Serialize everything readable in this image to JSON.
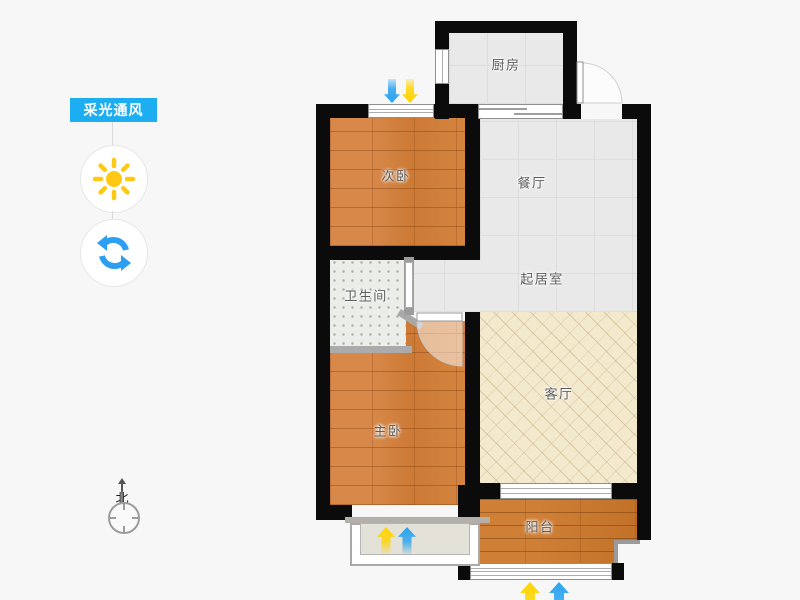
{
  "sidebar": {
    "tooltip": "采光通风",
    "compass": "北"
  },
  "rooms": {
    "kitchen": "厨房",
    "secondary_bedroom": "次卧",
    "dining": "餐厅",
    "bathroom": "卫生间",
    "sitting": "起居室",
    "master_bedroom": "主卧",
    "living": "客厅",
    "balcony": "阳台"
  },
  "icons": {
    "sun": "sun-icon",
    "rotate": "rotate-icon",
    "compass": "compass-icon",
    "entrance_arrows": [
      "down-arrow-blue",
      "down-arrow-yellow"
    ],
    "master_window_arrows": [
      "up-arrow-yellow",
      "up-arrow-blue"
    ],
    "balcony_arrows": [
      "up-arrow-yellow",
      "up-arrow-blue"
    ]
  },
  "colors": {
    "chip_bg": "#1daef2",
    "sun": "#ffc913",
    "rotate": "#2d9ff2",
    "arrow_blue": "#2aa3f0",
    "arrow_yellow": "#ffd400",
    "wall": "#0b0b0b",
    "wood_floor": "#d0813f",
    "balcony_floor": "#c8792f",
    "tile_floor": "#e9e9e9",
    "bath_floor": "#eaede8",
    "living_floor": "#f3e9cd",
    "background": "#f7f7f7"
  }
}
